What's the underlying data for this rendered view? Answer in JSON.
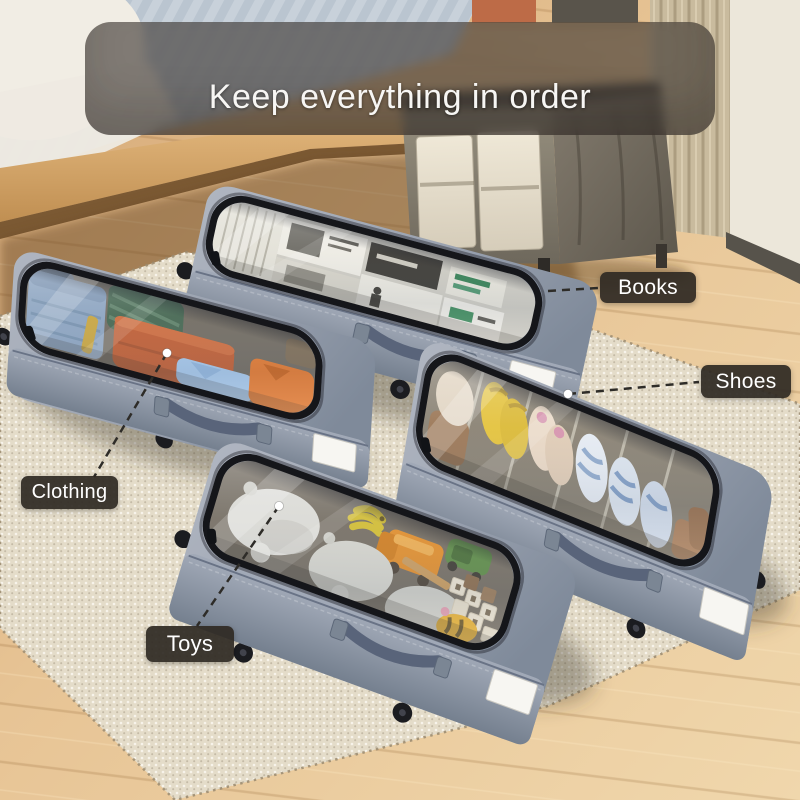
{
  "banner": {
    "title": "Keep everything in order"
  },
  "callouts": [
    {
      "id": "clothing",
      "label": "Clothing"
    },
    {
      "id": "books",
      "label": "Books"
    },
    {
      "id": "shoes",
      "label": "Shoes"
    },
    {
      "id": "toys",
      "label": "Toys"
    }
  ],
  "scene": {
    "description": "Four grey under-bed rolling storage organizers with clear zip-on tops, shown on a cream woven rug beside a bed and a nightstand; bins hold clothing, books, shoes and toys."
  },
  "colors": {
    "banner_overlay": "rgba(58,52,46,0.62)",
    "banner_text": "#f7f6f4",
    "tag_background": "#2f2a24",
    "tag_text": "#ffffff",
    "bin_fabric": "#8e97a6",
    "zipper_trim": "#15161a",
    "rug": "#e4dcc9",
    "floor": "#e2bc8d"
  }
}
